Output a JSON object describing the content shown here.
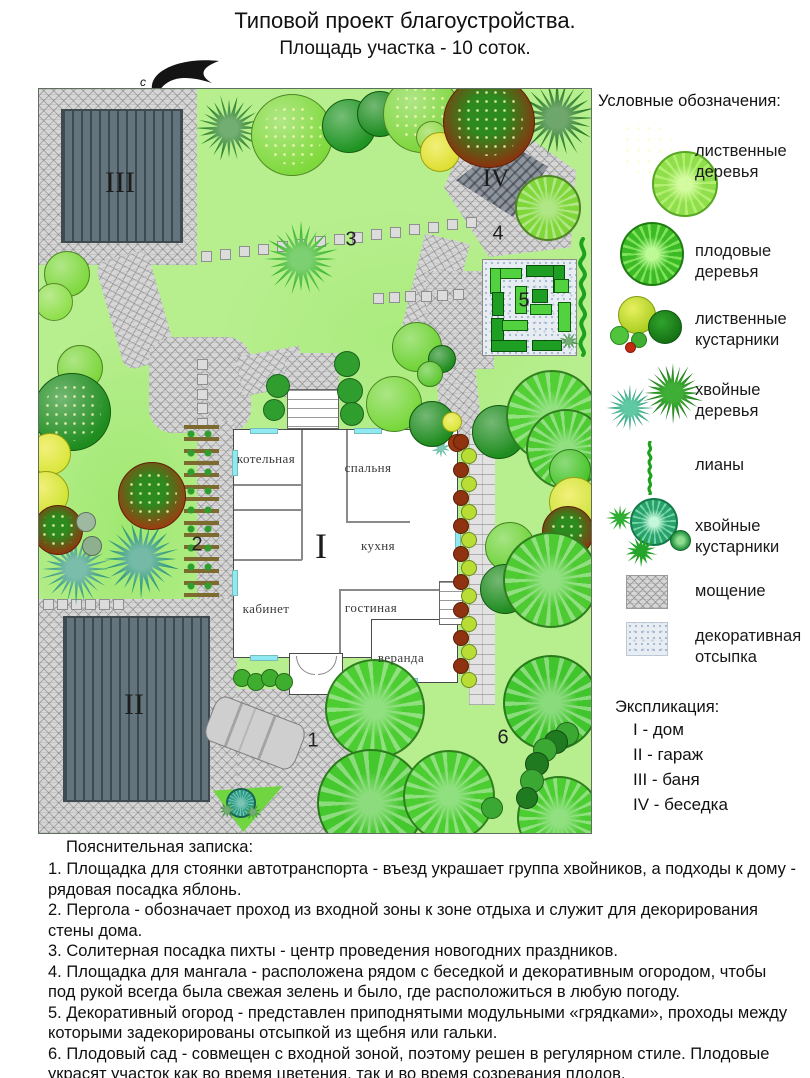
{
  "title": {
    "line1": "Типовой проект благоустройства.",
    "line2": "Площадь участка - 10 соток."
  },
  "compass": {
    "north_label": "с"
  },
  "plan": {
    "labels": {
      "house": "I",
      "garage": "II",
      "bath": "III",
      "gazebo": "IV",
      "parking": "1",
      "pergola": "2",
      "fir": "3",
      "bbq_area": "4",
      "kitchen_garden": "5",
      "orchard": "6"
    },
    "rooms": {
      "boiler_room": "котельная",
      "bedroom": "спальня",
      "kitchen": "кухня",
      "study": "кабинет",
      "living_room": "гостиная",
      "veranda": "веранда"
    }
  },
  "legend": {
    "title": "Условные обозначения:",
    "items": [
      {
        "label": "лиственные деревья"
      },
      {
        "label": "плодовые деревья"
      },
      {
        "label": "лиственные кустарники"
      },
      {
        "label": "хвойные деревья"
      },
      {
        "label": "лианы"
      },
      {
        "label": "хвойные кустарники"
      },
      {
        "label": "мощение"
      },
      {
        "label": "декоративная отсыпка"
      }
    ]
  },
  "explication": {
    "title": "Экспликация:",
    "items": [
      "I - дом",
      "II - гараж",
      "III - баня",
      "IV - беседка"
    ]
  },
  "notes": {
    "title": "Пояснительная записка:",
    "items": [
      "1. Площадка для стоянки автотранспорта - въезд украшает группа хвойников, а подходы к дому - рядовая посадка яблонь.",
      "2. Пергола - обозначает проход из входной зоны к зоне отдыха и служит для декорирования стены дома.",
      "3. Солитерная посадка пихты - центр проведения новогодних праздников.",
      "4. Площадка для мангала - расположена рядом с беседкой и декоративным огородом, чтобы под рукой всегда была свежая зелень  и было, где расположиться в любую погоду.",
      "5. Декоративный огород - представлен приподнятыми модульными «грядками», проходы между которыми задекорированы отсыпкой из щебня или гальки.",
      "6. Плодовый сад - совмещен с входной зоной, поэтому решен в регулярном стиле. Плодовые украсят участок как во время цветения, так и во время созревания плодов."
    ]
  },
  "colors": {
    "lawn": "#b7ee8e",
    "paving": "#d6d6d6",
    "building": "#64747c",
    "tree_dark": "#1f8c1f",
    "tree_light": "#7fd93c",
    "conifer_teal": "#2a9478",
    "fruit_tree": "#4ecb33",
    "red_tree": "#a03a10",
    "gravel": "#e8edf3"
  }
}
